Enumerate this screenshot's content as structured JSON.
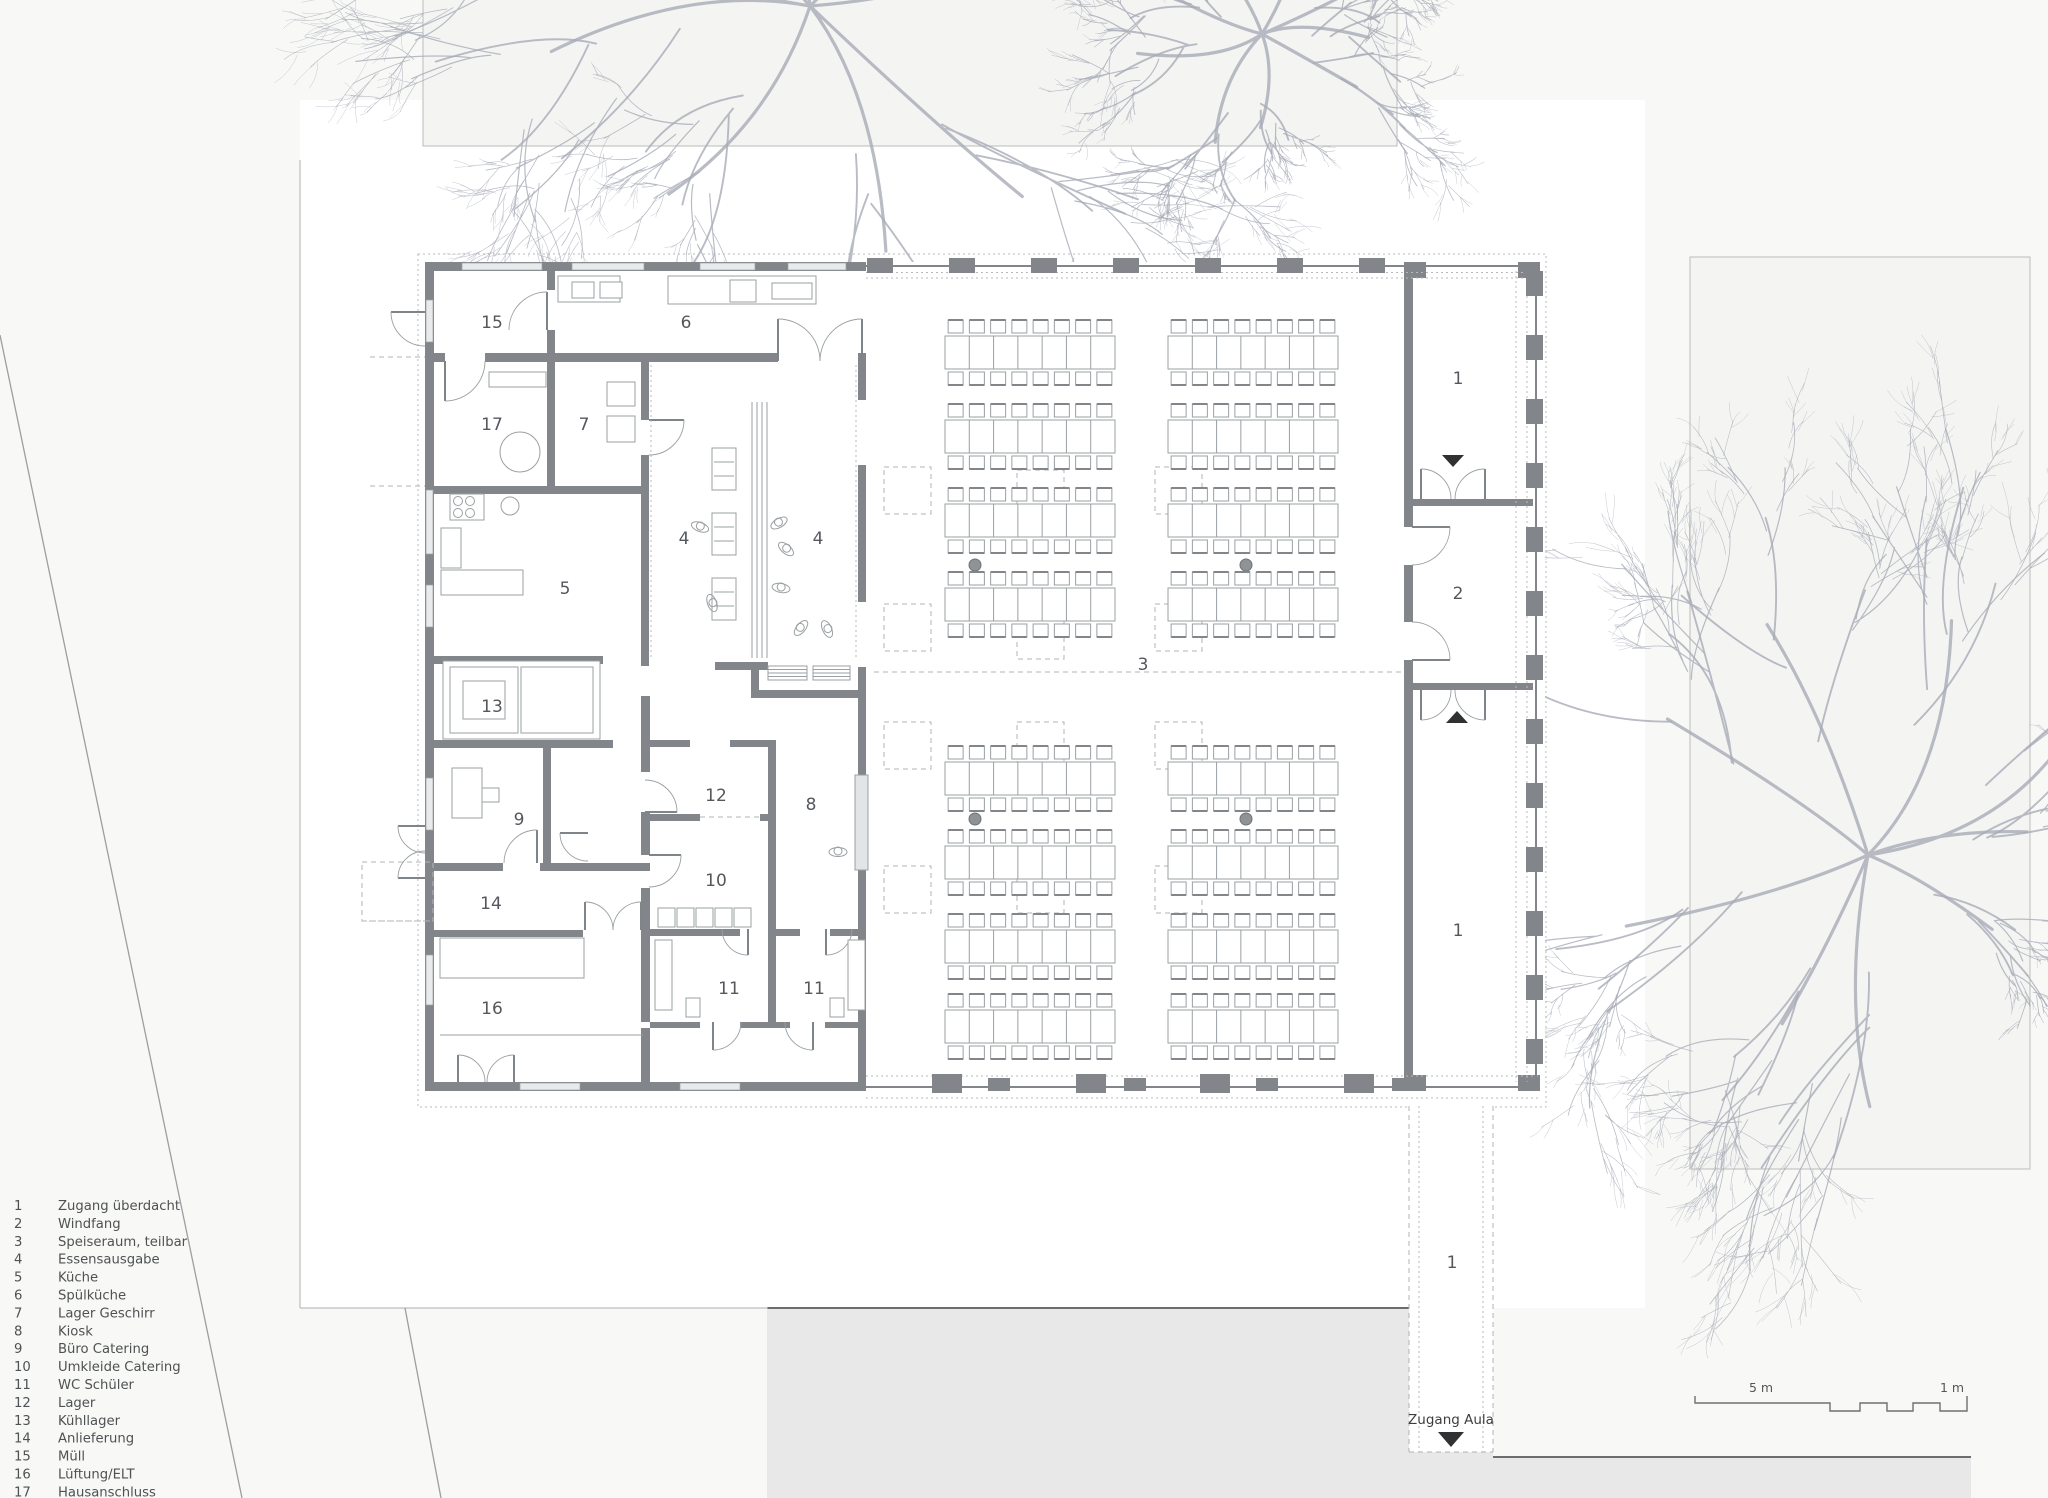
{
  "legend": {
    "items": [
      {
        "num": "1",
        "label": "Zugang überdacht"
      },
      {
        "num": "2",
        "label": "Windfang"
      },
      {
        "num": "3",
        "label": "Speiseraum, teilbar"
      },
      {
        "num": "4",
        "label": "Essensausgabe"
      },
      {
        "num": "5",
        "label": "Küche"
      },
      {
        "num": "6",
        "label": "Spülküche"
      },
      {
        "num": "7",
        "label": "Lager Geschirr"
      },
      {
        "num": "8",
        "label": "Kiosk"
      },
      {
        "num": "9",
        "label": "Büro Catering"
      },
      {
        "num": "10",
        "label": "Umkleide Catering"
      },
      {
        "num": "11",
        "label": "WC Schüler"
      },
      {
        "num": "12",
        "label": "Lager"
      },
      {
        "num": "13",
        "label": "Kühllager"
      },
      {
        "num": "14",
        "label": "Anlieferung"
      },
      {
        "num": "15",
        "label": "Müll"
      },
      {
        "num": "16",
        "label": "Lüftung/ELT"
      },
      {
        "num": "17",
        "label": "Hausanschluss"
      }
    ]
  },
  "plan_labels": [
    "15",
    "6",
    "17",
    "7",
    "4",
    "4",
    "5",
    "3",
    "13",
    "12",
    "9",
    "8",
    "10",
    "14",
    "11",
    "11",
    "16",
    "1",
    "2",
    "1",
    "1"
  ],
  "annotations": {
    "entrance_label": "Zugang Aula"
  },
  "scale_bar": {
    "major_label": "5 m",
    "minor_label": "1 m"
  },
  "colors": {
    "wall": "#82868a",
    "line": "#9aa0a3",
    "dashed": "#b0b3b6",
    "label": "#54585c",
    "panel_bg": "#f4f4f2",
    "panel_border": "#c6c6c4",
    "site_bg": "#ffffff",
    "page_bg": "#f8f8f6",
    "gray_area": "#e7e8e7",
    "gray_border": "#6b6e71",
    "tree": "#a7abb7",
    "column_dot": "#8f9396",
    "triangle": "#2f3133"
  }
}
